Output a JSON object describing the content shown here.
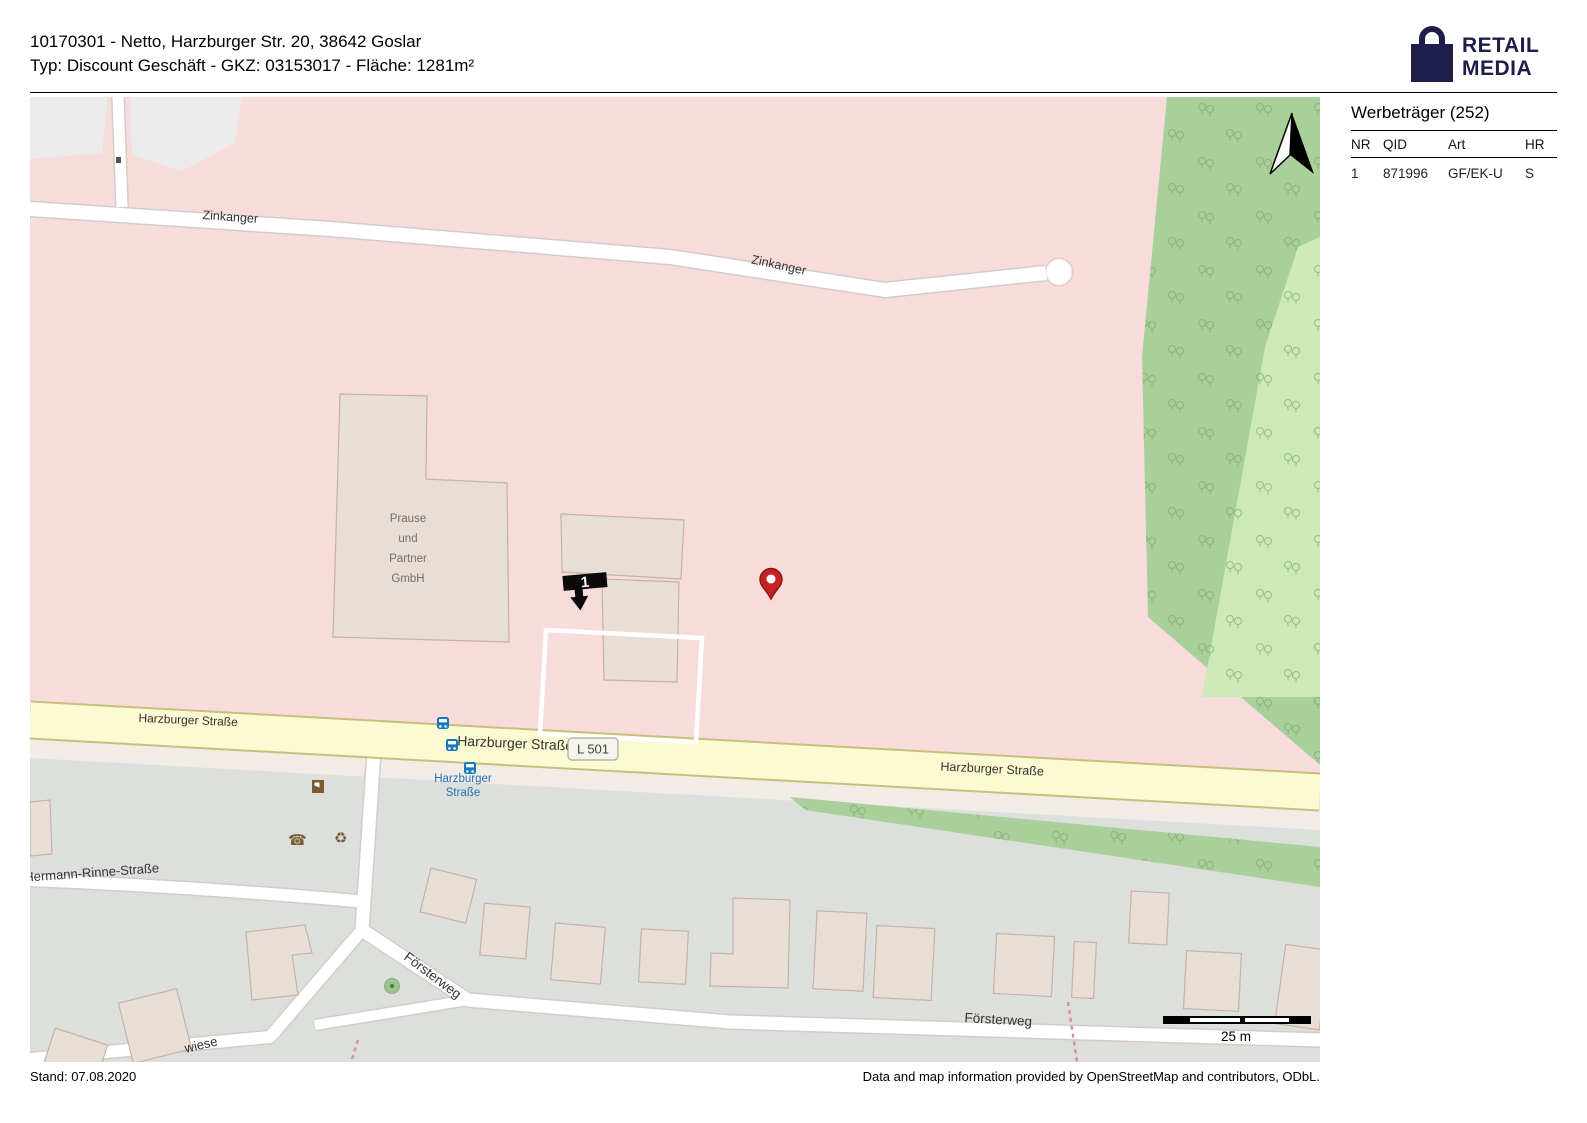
{
  "header": {
    "line1": "10170301 - Netto, Harzburger Str. 20, 38642 Goslar",
    "line2": "Typ: Discount Geschäft - GKZ: 03153017 - Fläche: 1281m²"
  },
  "logo": {
    "line1": "RETAIL",
    "line2": "MEDIA"
  },
  "sidebar": {
    "title": "Werbeträger (252)",
    "columns": [
      "NR",
      "QID",
      "Art",
      "HR"
    ],
    "rows": [
      [
        "1",
        "871996",
        "GF/EK-U",
        "S"
      ]
    ]
  },
  "map": {
    "streets": {
      "zinkanger": "Zinkanger",
      "harzburger": "Harzburger Straße",
      "hermann": "Hermann-Rinne-Straße",
      "foersterweg": "Försterweg",
      "wiese": "wiese"
    },
    "route_badge": "L 501",
    "busstop_lines": [
      "Harzburger",
      "Straße"
    ],
    "prause_lines": [
      "Prause",
      "und",
      "Partner",
      "GmbH"
    ],
    "marker_number": "1",
    "scale_label": "25 m"
  },
  "footer": {
    "left": "Stand: 07.08.2020",
    "right": "Data and map information provided by OpenStreetMap and contributors, ODbL."
  },
  "colors": {
    "brand_navy": "#1e1e4a",
    "residential_pink": "#f8dcdc",
    "forest_green": "#a9cf9b",
    "grass_green": "#cdeab6",
    "urban_grey": "#dddfdc",
    "road_yellow": "#fbfad2",
    "building_fill": "#e8ded6",
    "bus_blue": "#1678be",
    "poi_brown": "#7a5c33",
    "pin_red": "#c5231f"
  }
}
